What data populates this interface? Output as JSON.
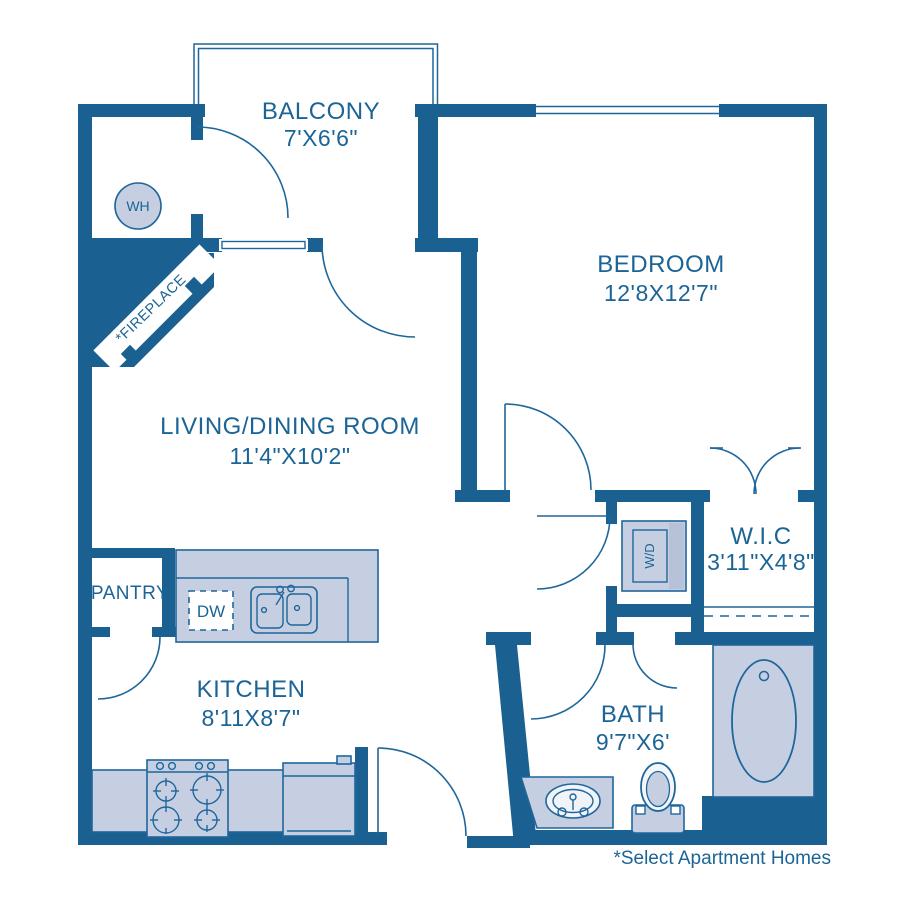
{
  "floorplan": {
    "footnote": "*Select Apartment Homes",
    "colors": {
      "wall": "#1a6090",
      "line": "#1f669b",
      "fill_light": "#c6cfe2",
      "fill_shade": "#b7c2d9",
      "text": "#1b6496"
    },
    "rooms": {
      "balcony": {
        "name": "BALCONY",
        "dims": "7'X6'6\""
      },
      "bedroom": {
        "name": "BEDROOM",
        "dims": "12'8X12'7\""
      },
      "living": {
        "name": "LIVING/DINING ROOM",
        "dims": "11'4\"X10'2\""
      },
      "wic": {
        "name": "W.I.C",
        "dims": "3'11\"X4'8\""
      },
      "kitchen": {
        "name": "KITCHEN",
        "dims": "8'11X8'7\""
      },
      "bath": {
        "name": "BATH",
        "dims": "9'7\"X6'"
      },
      "pantry": {
        "name": "PANTRY"
      }
    },
    "fixtures": {
      "water_heater": "WH",
      "dishwasher": "DW",
      "washer_dryer": "W/D",
      "fireplace": "*FIREPLACE"
    }
  }
}
